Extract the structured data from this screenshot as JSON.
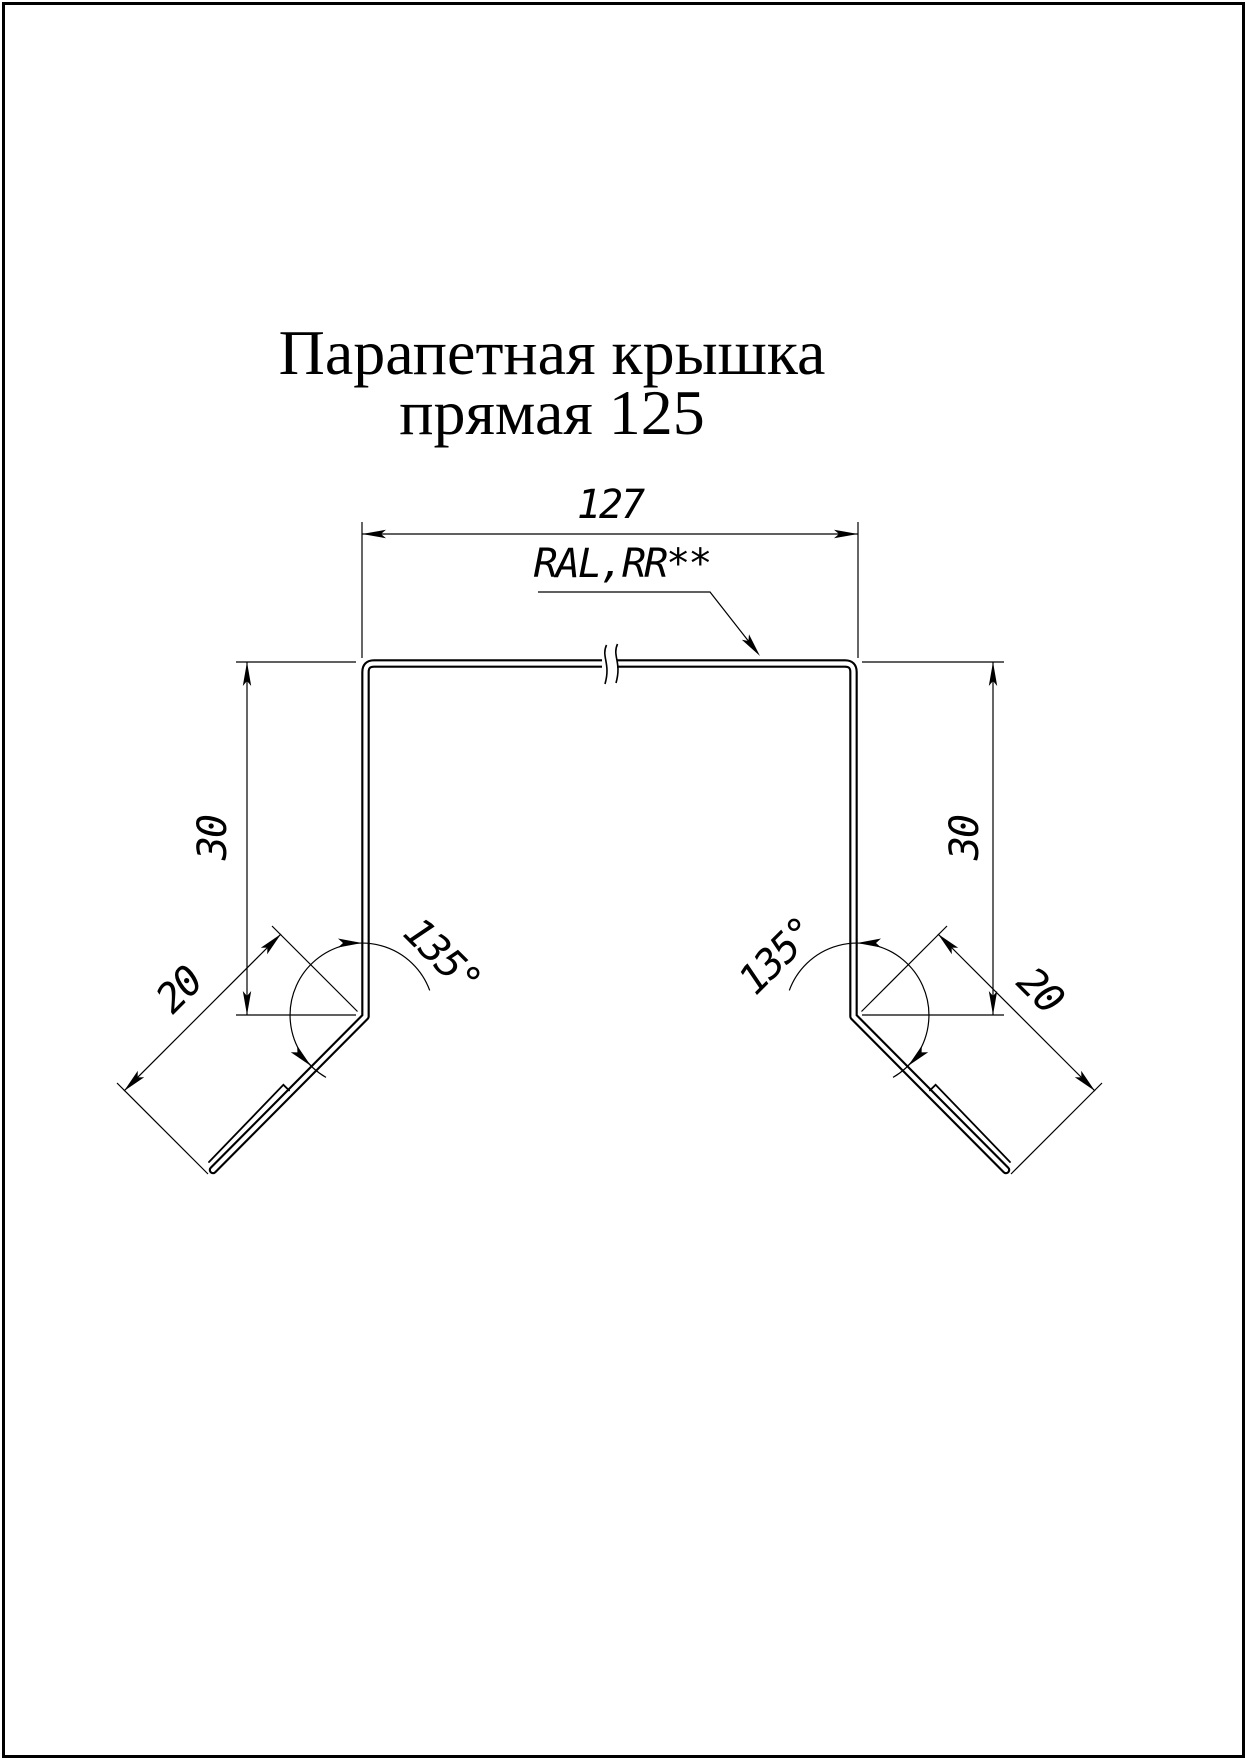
{
  "title": {
    "line1": "Парапетная крышка",
    "line2": "прямая 125"
  },
  "drawing": {
    "coating_label": "RAL,RR**",
    "dimensions": {
      "top_width": "127",
      "side_height_left": "30",
      "side_height_right": "30",
      "flange_left": "20",
      "flange_right": "20",
      "angle_left": "135°",
      "angle_right": "135°"
    }
  },
  "colors": {
    "line": "#000000",
    "background": "#ffffff"
  }
}
